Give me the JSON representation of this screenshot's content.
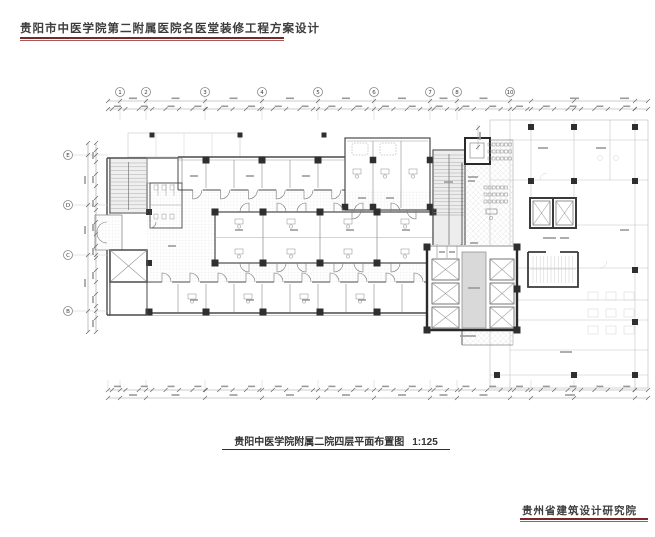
{
  "header": {
    "title": "贵阳市中医学院第二附属医院名医堂装修工程方案设计"
  },
  "plan": {
    "caption": "贵阳中医学院附属二院四层平面布置图",
    "scale": "1:125",
    "axis_top": {
      "labels": [
        "1",
        "2",
        "3",
        "4",
        "5",
        "6",
        "7",
        "8",
        "10"
      ],
      "x": [
        120,
        146,
        205,
        262,
        318,
        374,
        430,
        457,
        510
      ]
    },
    "axis_left": {
      "labels": [
        "E",
        "D",
        "C",
        "B"
      ],
      "y": [
        155,
        205,
        255,
        311
      ]
    }
  },
  "footer": {
    "company": "贵州省建筑设计研究院"
  },
  "colors": {
    "accent_red": "#7d2626",
    "wall_dark": "#4a4a4a",
    "wall_bold": "#2a2a2a",
    "column": "#2f2f2f",
    "existing_light": "#c2c2c2",
    "hatch": "#e0e0e0",
    "dim_line": "#9a9a9a",
    "text_dark": "#3d3d3d"
  }
}
